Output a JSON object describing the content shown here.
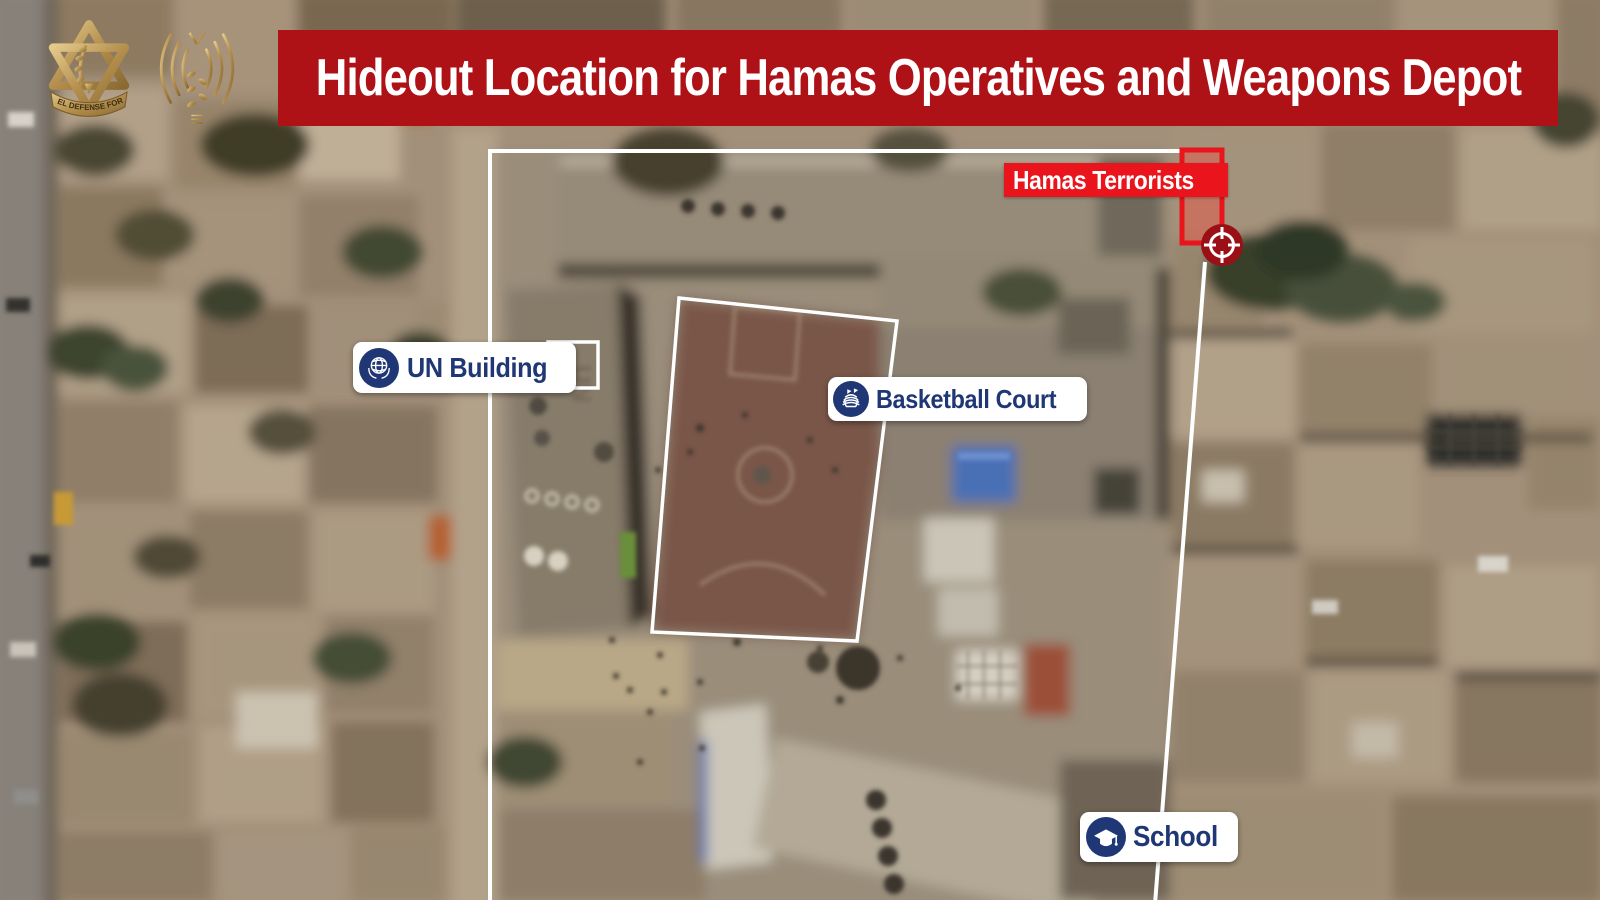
{
  "header": {
    "title": "Hideout Location for Hamas Operatives and Weapons Depot",
    "banner_color": "#ae1116",
    "logos": [
      {
        "name": "idf-emblem",
        "ribbon_text": "ISRAEL DEFENSE FORCES",
        "color": "#c9a85c"
      },
      {
        "name": "radio-antenna-emblem",
        "color": "#c9a85c"
      }
    ]
  },
  "map_labels": {
    "hamas_terrorists": {
      "text": "Hamas Terrorists",
      "bg_color": "#e9141c",
      "text_color": "#ffffff"
    },
    "un_building": {
      "text": "UN Building",
      "bg_color": "#ffffff",
      "text_color": "#1f3775",
      "icon": "un-globe-icon"
    },
    "basketball_court": {
      "text": "Basketball Court",
      "bg_color": "#ffffff",
      "text_color": "#1f3775",
      "icon": "stadium-icon"
    },
    "school": {
      "text": "School",
      "bg_color": "#ffffff",
      "text_color": "#1f3775",
      "icon": "graduation-cap-icon"
    }
  },
  "annotations": {
    "compound_outline_color": "#ffffff",
    "court_outline_color": "#ffffff",
    "un_roof_box_color": "#ffffff",
    "target_box_color": "#e9141c",
    "crosshair_color": "#9a1016",
    "roof_marking": "UN"
  }
}
